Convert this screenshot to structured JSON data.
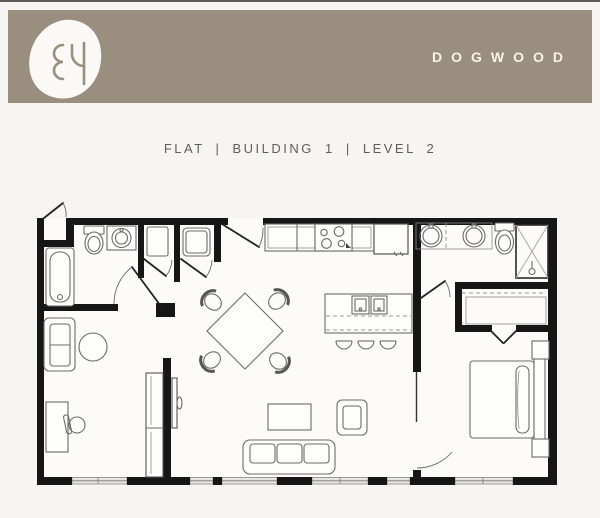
{
  "meta": {
    "page_bg": "#f7f5f1",
    "top_border_color": "#5c5c5c"
  },
  "header": {
    "title": "DOGWOOD",
    "monogram": "ƐЧ",
    "banner_color": "#9a8f7e",
    "logo_bg": "#fbf9f5",
    "title_color": "#f6f3ec"
  },
  "subtitle": {
    "text": "FLAT | BUILDING 1 | LEVEL 2",
    "color": "#5e5e5e"
  },
  "floorplan": {
    "wall_color": "#161616",
    "fixture_color": "#6b6b6b",
    "window_fill": "#e8e5df",
    "fixtures": [
      "entry-door",
      "coat-closet",
      "bathtub",
      "toilet",
      "vanity-sink",
      "water-heater-closet",
      "washer-dryer-closet",
      "kitchen-counter",
      "range",
      "refrigerator",
      "island-with-double-sink",
      "bar-stools",
      "dining-table",
      "dining-chairs",
      "sofa",
      "coffee-table",
      "armchair",
      "loveseat",
      "round-side-table",
      "desk",
      "desk-chair",
      "wardrobe",
      "double-vanity",
      "master-toilet",
      "shower",
      "walk-in-closet",
      "bed",
      "nightstands",
      "windows"
    ]
  }
}
